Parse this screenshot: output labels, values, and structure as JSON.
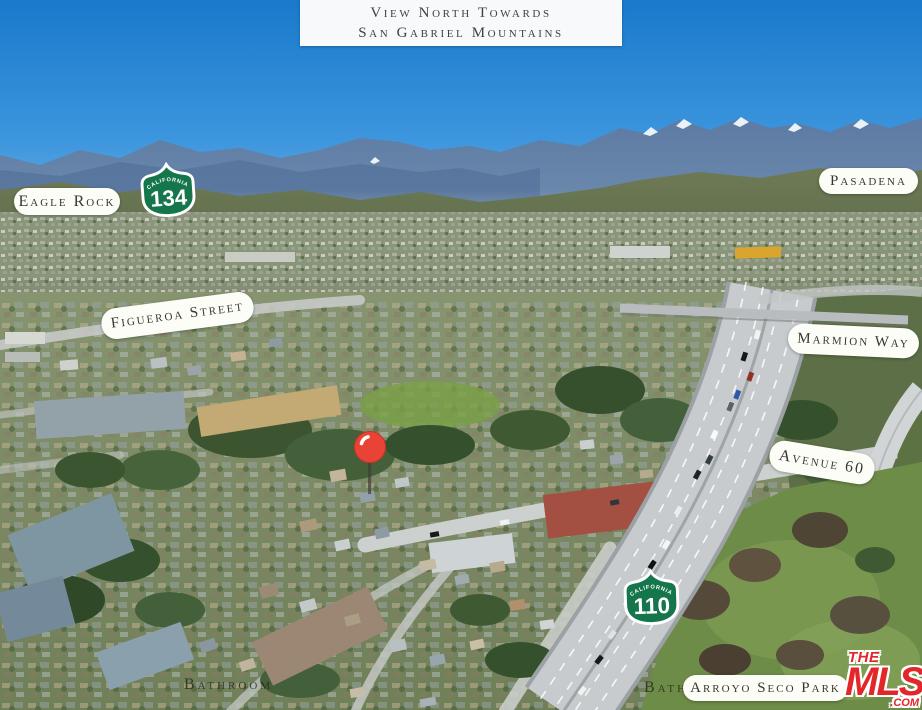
{
  "caption": {
    "line1": "View North Towards",
    "line2": "San Gabriel Mountains"
  },
  "labels": {
    "eagle_rock": "Eagle Rock",
    "pasadena": "Pasadena",
    "figueroa_street": "Figueroa Street",
    "marmion_way": "Marmion Way",
    "avenue_60": "Avenue 60",
    "arroyo_seco_park": "Arroyo Seco Park"
  },
  "shields": {
    "s134": {
      "state": "California",
      "route": "134"
    },
    "s110": {
      "state": "California",
      "route": "110"
    }
  },
  "watermarks": {
    "bathroom": "Bathroom",
    "bath_partial": "Bath"
  },
  "marker": {
    "type": "red-map-pin"
  },
  "logo": {
    "the": "THE",
    "mls": "MLS",
    "tm": "™",
    "com": ".COM"
  },
  "colors": {
    "shield_green": "#15764b",
    "label_bg": "#fdfdf8",
    "label_text": "#39362d",
    "pin_red": "#e94335",
    "mls_red": "#e2272a",
    "sky_top": "#1a79cc"
  }
}
